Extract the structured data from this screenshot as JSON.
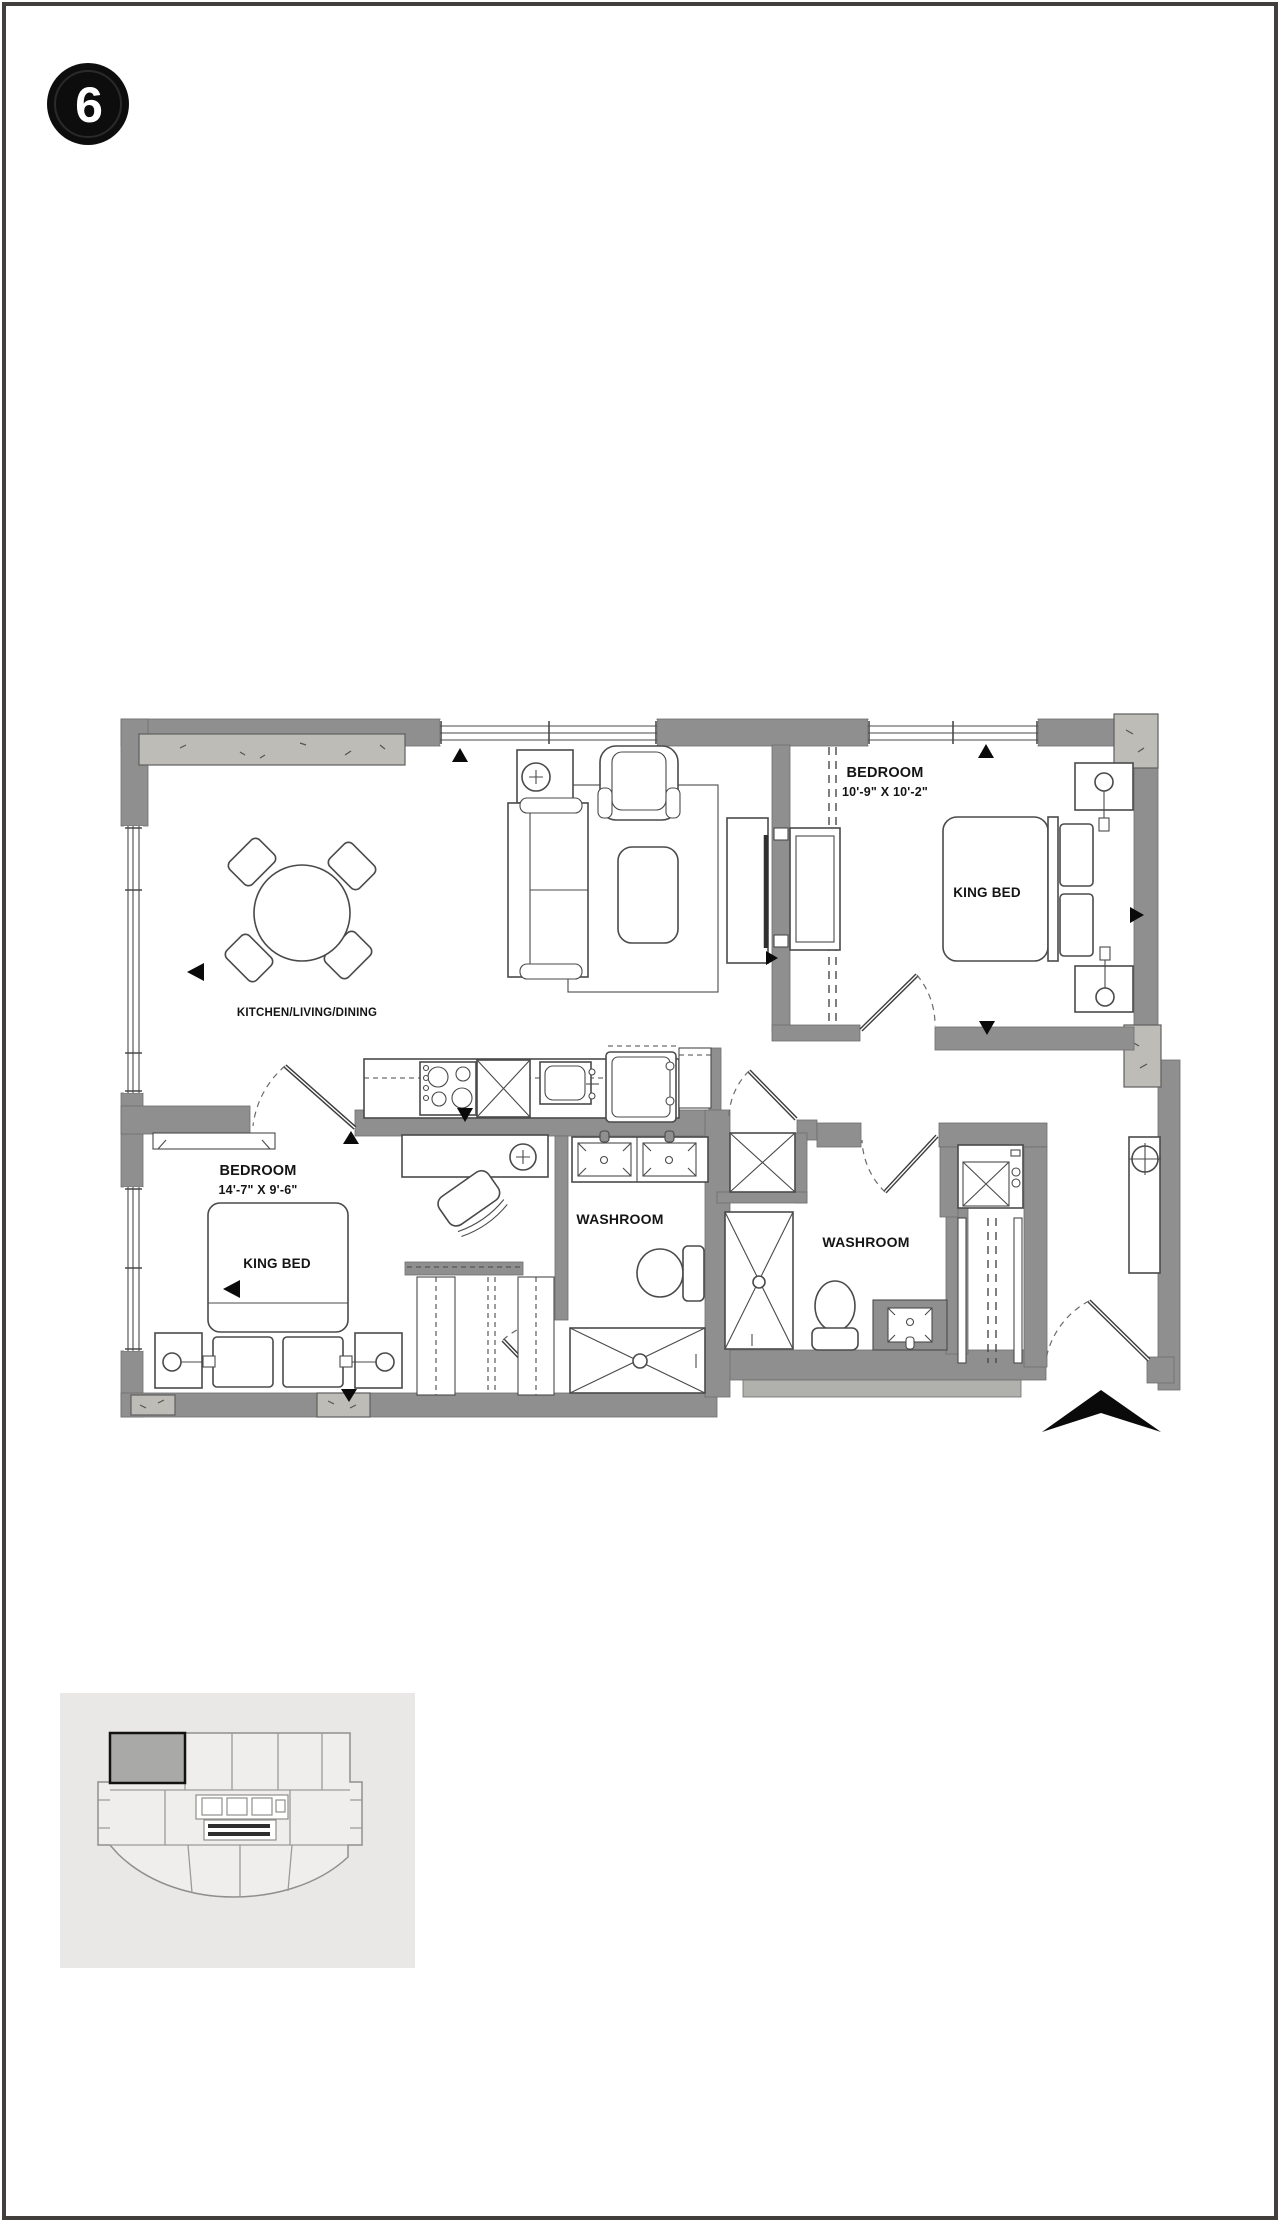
{
  "badge": {
    "number": "6"
  },
  "floor_plan": {
    "rooms": {
      "kitchen_living_dining": {
        "name": "KITCHEN/LIVING/DINING"
      },
      "bedroom_1": {
        "name": "BEDROOM",
        "dimensions": "10'-9\" X 10'-2\"",
        "bed": "KING BED"
      },
      "bedroom_2": {
        "name": "BEDROOM",
        "dimensions": "14'-7\" X 9'-6\"",
        "bed": "KING BED"
      },
      "washroom_ensuite": {
        "name": "WASHROOM"
      },
      "washroom_main": {
        "name": "WASHROOM"
      }
    },
    "colors": {
      "wall_gray": "#8f8f8f",
      "concrete_gray": "#bdbcb6",
      "line": "#4a4a4a",
      "label_text": "#141414",
      "north_arrow": "#000000"
    }
  },
  "key_plan": {
    "background": "#e9e8e6",
    "unit_highlight": "#a9a9a7",
    "line": "#9a9a98"
  }
}
